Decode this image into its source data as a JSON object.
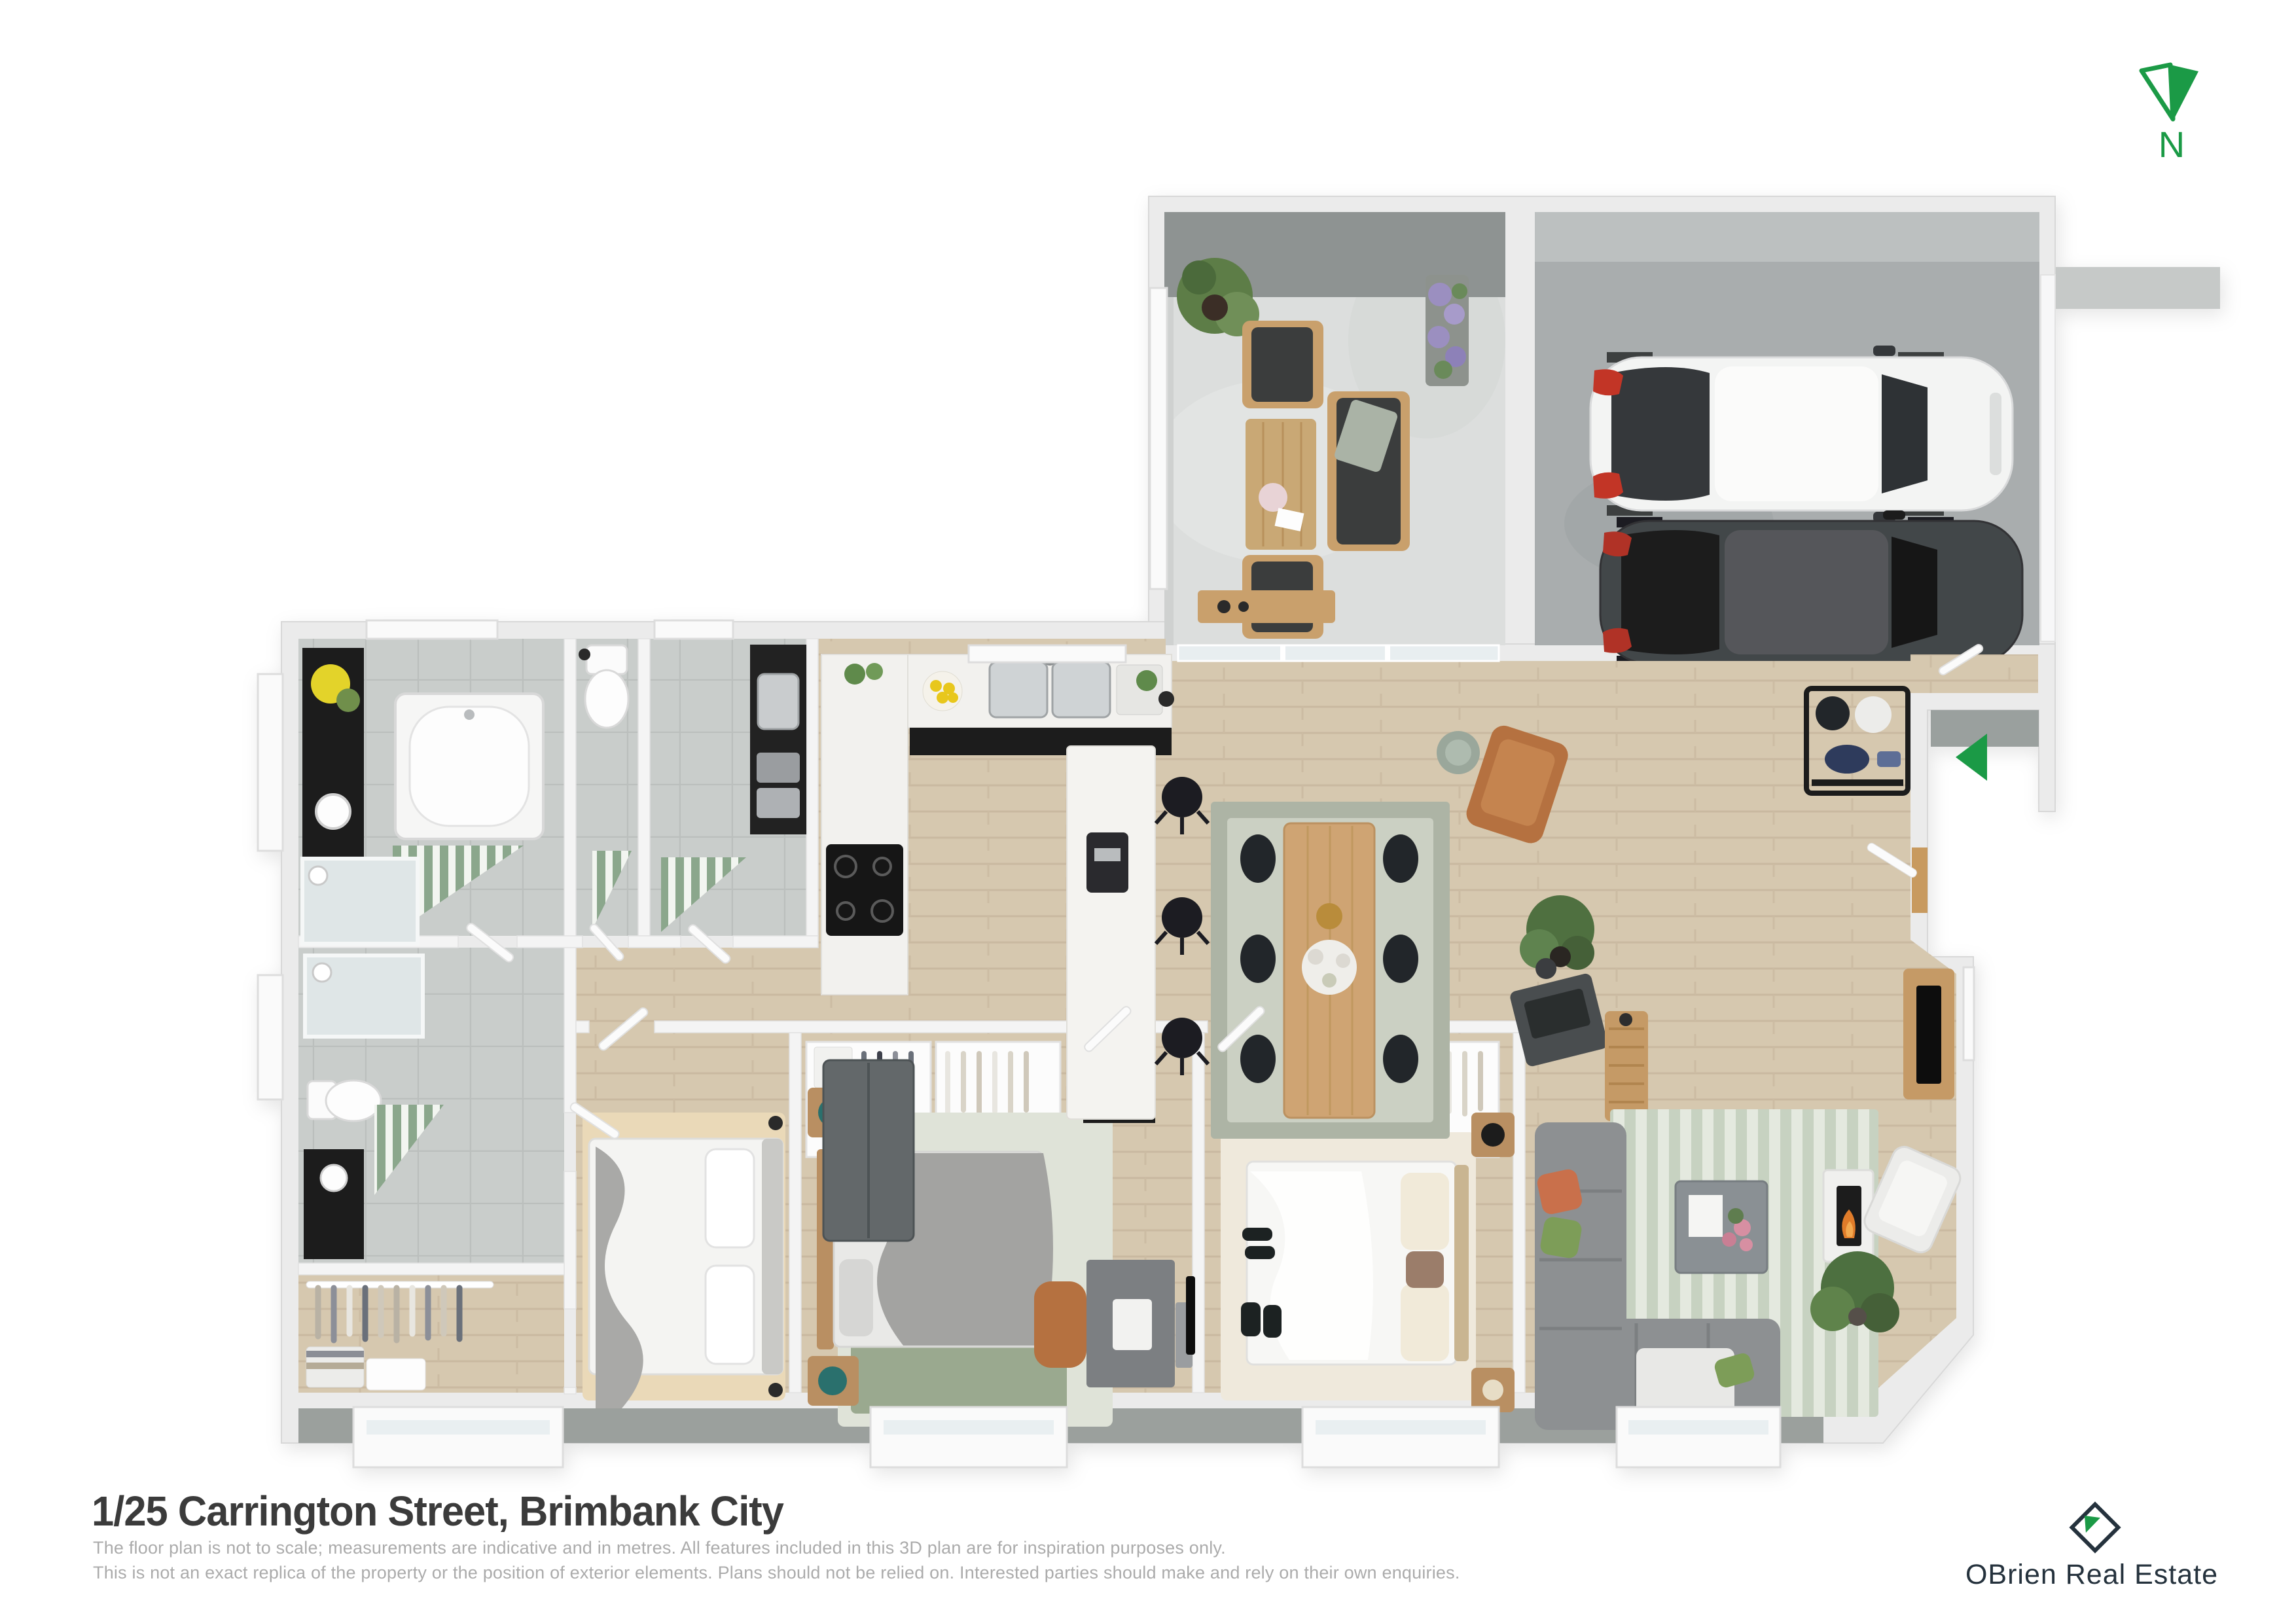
{
  "north": {
    "label": "N",
    "icon": "compass-north-icon"
  },
  "entry": {
    "icon": "entry-direction-arrow-icon"
  },
  "footer": {
    "address": "1/25 Carrington Street, Brimbank City",
    "disclaimer_line1": "The floor plan is not to scale; measurements are indicative and in metres. All features included in this 3D plan are for inspiration purposes only.",
    "disclaimer_line2": "This is not an exact replica of the property or the position of exterior elements. Plans should not be relied on. Interested parties should make and rely on their own enquiries."
  },
  "branding": {
    "name": "OBrien Real Estate",
    "icon": "diamond-flag-icon"
  },
  "colors": {
    "accent_green": "#1b9a46",
    "brand_navy": "#25323d",
    "title_text": "#3b3b3b",
    "disclaimer_text": "#ababab",
    "wall": "#ebebeb",
    "timber_floor": "#d6c8af",
    "tile_floor": "#c9cdcb",
    "patio_concrete": "#dcdedd",
    "garage_concrete": "#a9adae",
    "rug_sage": "#c7d2c1",
    "accent_mat_green": "#8ba78c"
  }
}
